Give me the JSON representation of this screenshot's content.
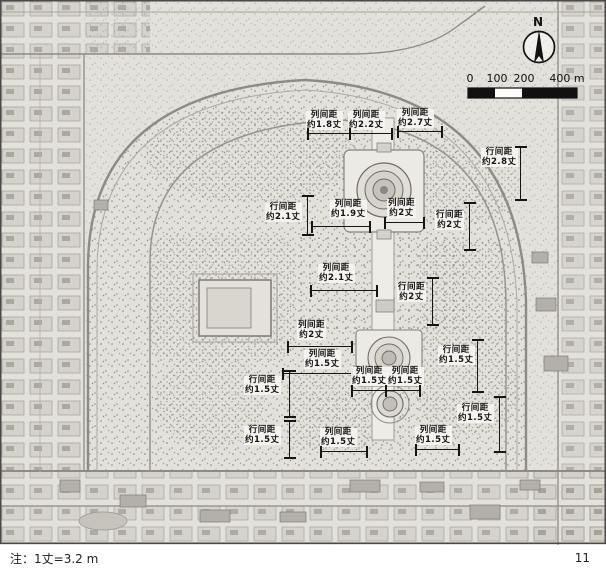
{
  "figure": {
    "note": "注：1丈=3.2 m",
    "page_number": "11"
  },
  "map": {
    "north_label": "N",
    "scale_bar": {
      "labels": [
        "0",
        "100",
        "200",
        "400 m"
      ]
    },
    "annotations": [
      {
        "label": "列间距",
        "value": "约1.8丈",
        "x": 306,
        "y": 111,
        "dim": [
          308,
          133,
          350,
          133
        ]
      },
      {
        "label": "列间距",
        "value": "约2.2丈",
        "x": 348,
        "y": 111,
        "dim": [
          350,
          133,
          392,
          133
        ]
      },
      {
        "label": "列间距",
        "value": "约2.7丈",
        "x": 397,
        "y": 109,
        "dim": [
          398,
          131,
          442,
          131
        ]
      },
      {
        "label": "行间距",
        "value": "约2.8丈",
        "x": 481,
        "y": 148,
        "dim": [
          520,
          147,
          520,
          200
        ]
      },
      {
        "label": "行间距",
        "value": "约2.1丈",
        "x": 265,
        "y": 203,
        "dim": [
          307,
          196,
          307,
          235
        ]
      },
      {
        "label": "列间距",
        "value": "约1.9丈",
        "x": 330,
        "y": 200,
        "dim": [
          312,
          226,
          370,
          226
        ]
      },
      {
        "label": "列间距",
        "value": "约2丈",
        "x": 387,
        "y": 199,
        "dim": [
          385,
          222,
          424,
          222
        ]
      },
      {
        "label": "行间距",
        "value": "约2丈",
        "x": 435,
        "y": 211,
        "dim": [
          469,
          203,
          469,
          250
        ]
      },
      {
        "label": "列间距",
        "value": "约2.1丈",
        "x": 318,
        "y": 264,
        "dim": [
          311,
          290,
          377,
          290
        ]
      },
      {
        "label": "行间距",
        "value": "约2丈",
        "x": 397,
        "y": 283,
        "dim": [
          432,
          278,
          432,
          325
        ]
      },
      {
        "label": "列间距",
        "value": "约2丈",
        "x": 297,
        "y": 321,
        "dim": [
          288,
          346,
          352,
          346
        ]
      },
      {
        "label": "列间距",
        "value": "约1.5丈",
        "x": 304,
        "y": 350,
        "dim": [
          283,
          373,
          352,
          373
        ]
      },
      {
        "label": "行间距",
        "value": "约1.5丈",
        "x": 438,
        "y": 346,
        "dim": [
          477,
          340,
          477,
          392
        ]
      },
      {
        "label": "行间距",
        "value": "约1.5丈",
        "x": 244,
        "y": 376,
        "dim": [
          289,
          371,
          289,
          417
        ]
      },
      {
        "label": "列间距",
        "value": "约1.5丈",
        "x": 351,
        "y": 367,
        "dim": [
          352,
          390,
          386,
          390
        ]
      },
      {
        "label": "列间距",
        "value": "约1.5丈",
        "x": 387,
        "y": 367,
        "dim": [
          386,
          390,
          420,
          390
        ]
      },
      {
        "label": "行间距",
        "value": "约1.5丈",
        "x": 457,
        "y": 404,
        "dim": [
          499,
          397,
          499,
          452
        ]
      },
      {
        "label": "行间距",
        "value": "约1.5丈",
        "x": 244,
        "y": 426,
        "dim": [
          289,
          421,
          289,
          458
        ]
      },
      {
        "label": "列间距",
        "value": "约1.5丈",
        "x": 320,
        "y": 428,
        "dim": [
          321,
          451,
          367,
          451
        ]
      },
      {
        "label": "列间距",
        "value": "约1.5丈",
        "x": 415,
        "y": 426,
        "dim": [
          416,
          449,
          459,
          449
        ]
      }
    ]
  }
}
